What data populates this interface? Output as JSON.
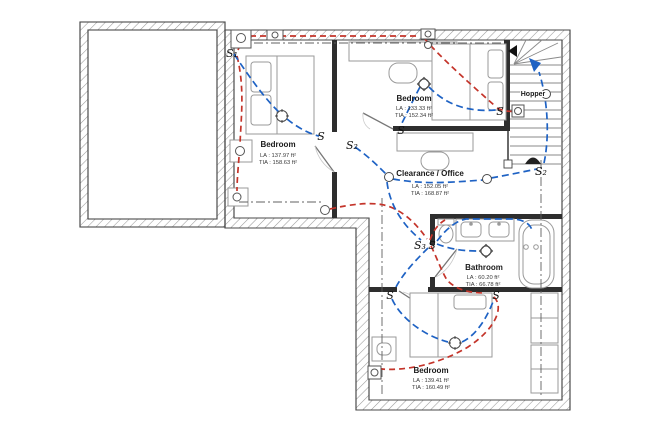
{
  "colors": {
    "wiring_blue": "#1e62c4",
    "wiring_red": "#c4342a",
    "wall_dark": "#2e2e2e",
    "wall_outline": "#4a4a4a",
    "hatch": "#9a9a9a",
    "furniture": "#9a9a9a",
    "centerline": "#606060",
    "text_primary": "#1a1a1a",
    "text_secondary": "#3a3a3a"
  },
  "rooms": {
    "bedroom_left": {
      "name": "Bedroom",
      "la": "LA : 137.97 ft²",
      "tia": "TIA : 158.63 ft²"
    },
    "bedroom_top": {
      "name": "Bedroom",
      "la": "LA : 133.33 ft²",
      "tia": "TIA : 152.34 ft²"
    },
    "hopper": {
      "name": "Hopper"
    },
    "office": {
      "name": "Clearance / Office",
      "la": "LA : 152.05 ft²",
      "tia": "TIA : 168.87 ft²"
    },
    "bathroom": {
      "name": "Bathroom",
      "la": "LA : 60.20 ft²",
      "tia": "TIA : 66.78 ft²"
    },
    "bedroom_bottom": {
      "name": "Bedroom",
      "la": "LA : 139.41 ft²",
      "tia": "TIA : 160.49 ft²"
    }
  },
  "switches": [
    {
      "label": "S₁"
    },
    {
      "label": "S"
    },
    {
      "label": "S₂"
    },
    {
      "label": "S"
    },
    {
      "label": "S"
    },
    {
      "label": "S₂"
    },
    {
      "label": "S₃"
    },
    {
      "label": "S"
    },
    {
      "label": "S"
    },
    {
      "label": "S"
    }
  ]
}
